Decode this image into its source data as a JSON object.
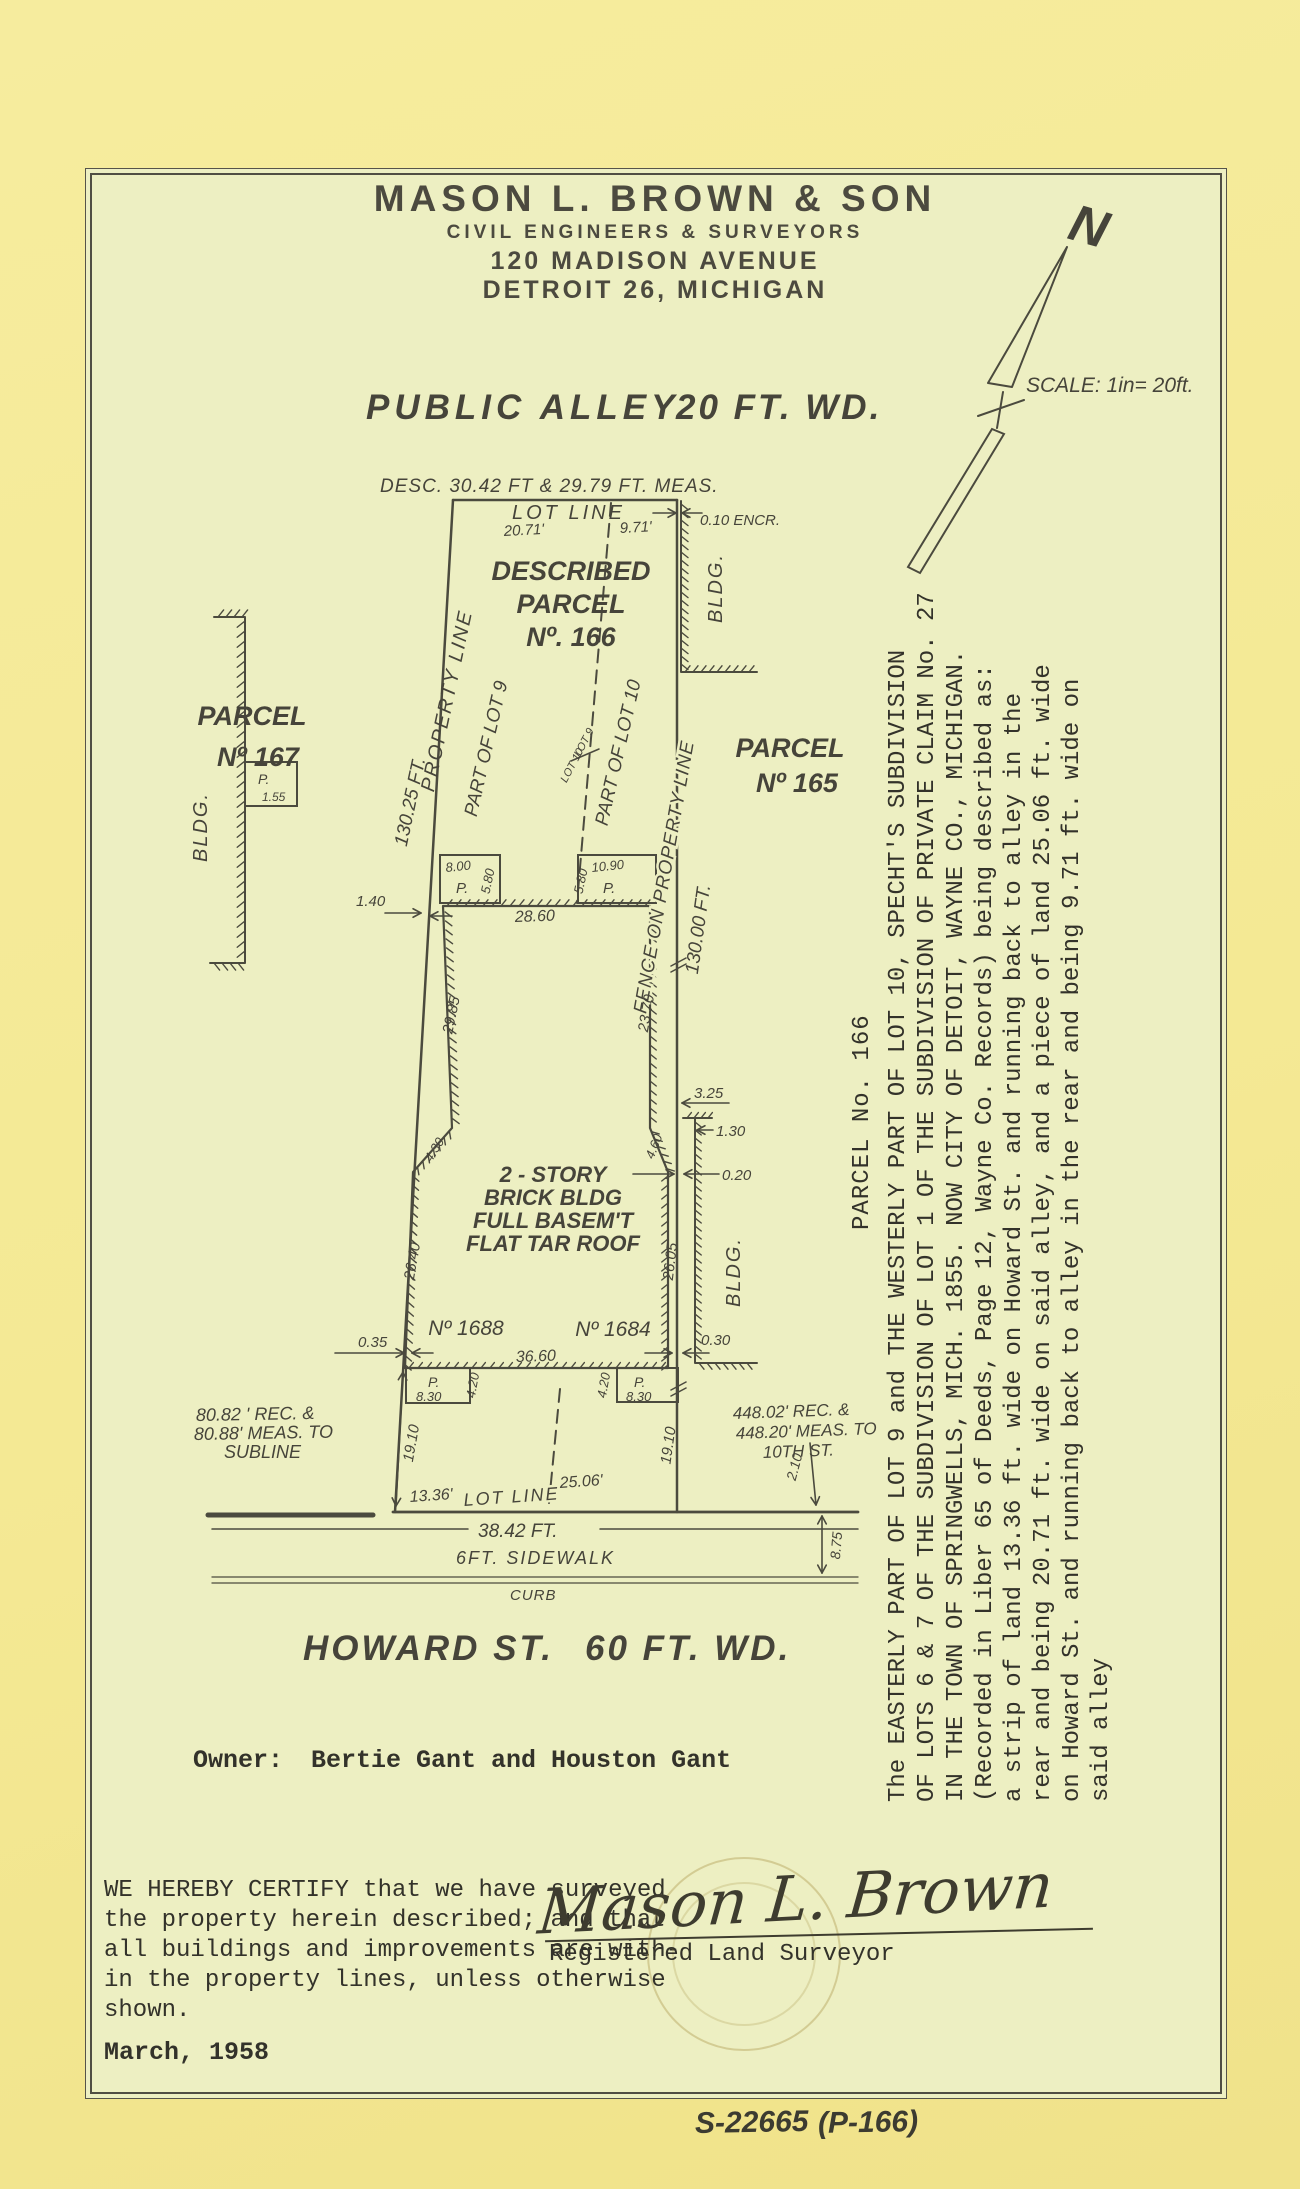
{
  "letterhead": {
    "company": "MASON L. BROWN & SON",
    "subtitle": "CIVIL ENGINEERS & SURVEYORS",
    "address1": "120 MADISON AVENUE",
    "address2": "DETROIT 26, MICHIGAN"
  },
  "north": {
    "label": "N",
    "scale_note": "SCALE: 1in= 20ft."
  },
  "alley": {
    "left": "PUBLIC ALLEY",
    "right": "20 FT. WD."
  },
  "plat": {
    "desc_meas": "DESC. 30.42 FT & 29.79 FT. MEAS.",
    "lot_line_top": "LOT LINE",
    "dim_2071": "20.71'",
    "dim_971": "9.71'",
    "encroachment": "0.10 ENCR.",
    "described_l1": "DESCRIBED",
    "described_l2": "PARCEL",
    "described_l3": "Nº. 166",
    "bldg_ne": "BLDG.",
    "bldg_w": "BLDG.",
    "bldg_se": "BLDG.",
    "parcel167_l1": "PARCEL",
    "parcel167_l2": "Nº 167",
    "parcel165_l1": "PARCEL",
    "parcel165_l2": "Nº 165",
    "property_line_left": "PROPERTY LINE",
    "dim_13025": "130.25 FT.",
    "part_of_lot9": "PART OF LOT 9",
    "lot9": "LOT 9",
    "lot10": "LOT 10",
    "part_of_lot10": "PART OF LOT 10",
    "fence_label": "FENCE ON PROPERTY LINE",
    "dim_13000": "130.00 FT.",
    "dim_140": "1.40",
    "porch_nw_top": "8.00",
    "porch_nw_p": "P.",
    "porch_nw_side": "5.80",
    "porch_ne_side": "5.80",
    "porch_ne_top": "10.90",
    "porch_ne_p": "P.",
    "dim_2860": "28.60",
    "dim_2985": "29.85",
    "dim_2370": "23.70",
    "west_porch_p": "P.",
    "west_porch_dim": "1.55",
    "building_l1": "2 - STORY",
    "building_l2": "BRICK BLDG",
    "building_l3": "FULL BASEM'T",
    "building_l4": "FLAT TAR ROOF",
    "dim_325": "3.25",
    "dim_130": "1.30",
    "dim_020": "0.20",
    "dim_430": "4.30",
    "dim_460": "4.60",
    "dim_2640": "26.40",
    "dim_2605": "26.05",
    "dim_035": "0.35",
    "dim_030": "0.30",
    "house_1688": "Nº 1688",
    "house_1684": "Nº 1684",
    "dim_3660": "36.60",
    "porch_sw_p": "P.",
    "porch_sw_dim": "8.30",
    "porch_sw_side": "4.20",
    "porch_se_p": "P.",
    "porch_se_dim": "8.30",
    "porch_se_side": "4.20",
    "dim_1910_w": "19.10",
    "dim_1910_e": "19.10",
    "dim_1336": "13.36'",
    "lot_line_bottom": "LOT LINE",
    "dim_2506": "25.06'",
    "rec_west_l1": "80.82 ' REC. &",
    "rec_west_l2": "80.88' MEAS. TO",
    "rec_west_l3": "SUBLINE",
    "rec_east_l1": "448.02' REC. &",
    "rec_east_l2": "448.20' MEAS. TO",
    "rec_east_l3": "10TH ST.",
    "dim_210": "2.10",
    "dim_875": "8.75",
    "dim_3842": "38.42 FT.",
    "sidewalk": "6FT. SIDEWALK",
    "curb": "CURB",
    "howard_left": "HOWARD ST.",
    "howard_right": "60 FT. WD."
  },
  "legal": {
    "parcel_label": "PARCEL No. 166",
    "text": "The EASTERLY PART OF LOT 9 and THE WESTERLY PART OF LOT 10, SPECHT'S SUBDIVISION\nOF LOTS 6 & 7 OF THE SUBDIVISION OF LOT 1 OF THE SUBDIVISION OF PRIVATE CLAIM No. 27\nIN THE TOWN OF SPRINGWELLS, MICH. 1855. NOW CITY OF DETOIT, WAYNE CO., MICHIGAN.\n(Recorded in Liber 65 of Deeds, Page 12, Wayne Co. Records) being described as:\na strip of land 13.36 ft. wide on Howard St. and running back to alley in the\nrear and being 20.71 ft. wide on said alley, and a piece of land 25.06 ft. wide\non Howard St. and running back to alley in the rear and being 9.71 ft. wide on\nsaid alley"
  },
  "owner": {
    "label": "Owner:",
    "name": "Bertie Gant and Houston Gant"
  },
  "certification": {
    "text": "WE HEREBY CERTIFY that we have surveyed\nthe property herein described; and that\nall buildings and improvements are with-\nin the property lines, unless otherwise\nshown.",
    "date": "March, 1958"
  },
  "signature": {
    "script": "Mason L. Brown",
    "title": "Registered Land Surveyor"
  },
  "footer": {
    "job_number": "S-22665",
    "page": "(P-166)"
  }
}
